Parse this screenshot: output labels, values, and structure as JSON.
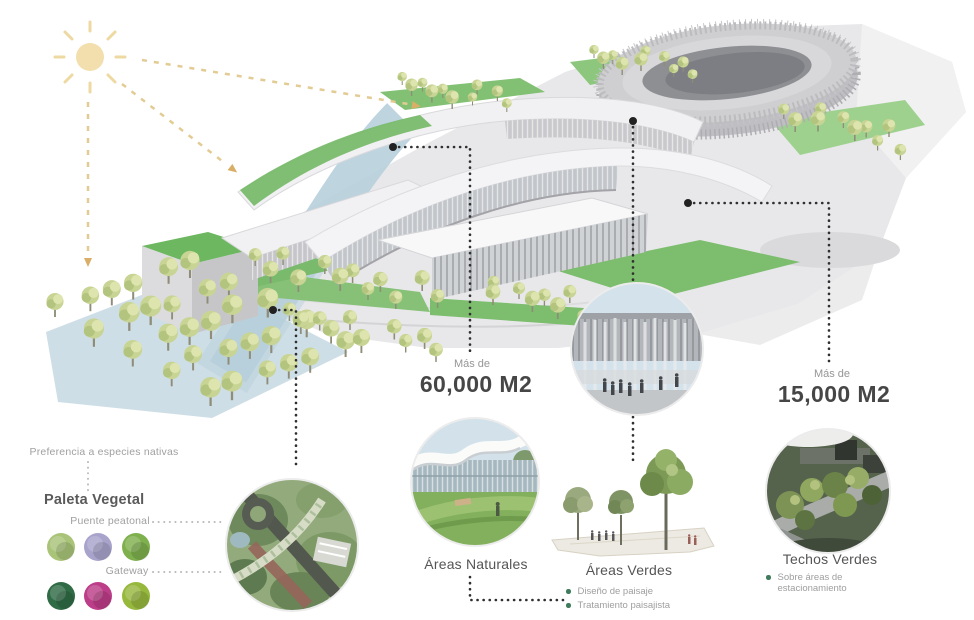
{
  "palette": {
    "note": "Preferencia a especies nativas",
    "title": "Paleta Vegetal",
    "groups": [
      {
        "label": "Puente peatonal",
        "swatches": [
          "#a9c478",
          "#a8a3cb",
          "#7fb04e"
        ]
      },
      {
        "label": "Gateway",
        "swatches": [
          "#2f6b45",
          "#bc3d88",
          "#96b83d"
        ]
      }
    ]
  },
  "callouts": {
    "naturales": {
      "more": "Más de",
      "value": "60,000 M2",
      "label": "Áreas Naturales",
      "bullets": [
        "Diseño de paisaje",
        "Tratamiento paisajista"
      ]
    },
    "verdes": {
      "label": "Áreas Verdes"
    },
    "techos": {
      "more": "Más de",
      "value": "15,000 M2",
      "label": "Techos Verdes",
      "bullets": [
        "Sobre áreas de estacionamiento"
      ]
    }
  },
  "colors": {
    "bullet_green": "#3e7c5b",
    "value_text": "#464646",
    "muted_text": "#9e9e9e",
    "leader_dots": "#2f2f2f",
    "sun": "#f3dfae",
    "canopy_green": "#74b566",
    "water_blue": "#b7cfdc"
  }
}
